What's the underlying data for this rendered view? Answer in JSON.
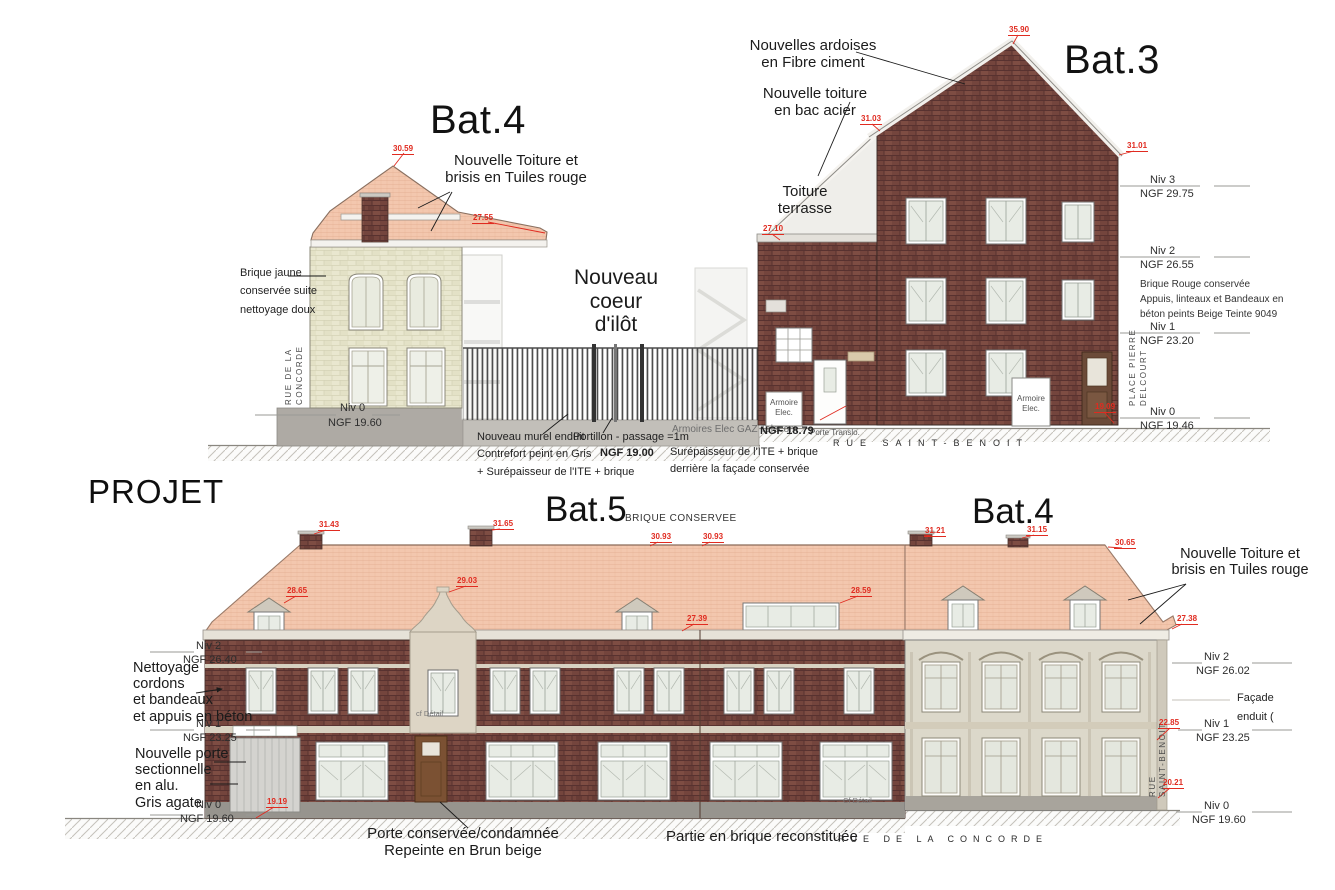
{
  "palette": {
    "brick_red": "#74453d",
    "brick_yellow": "#e9e7cf",
    "roof_tile": "#f3c7ae",
    "facade_cream": "#dcd8ca",
    "marker_red": "#e02b20",
    "ground_gray": "#b3b0aa"
  },
  "top": {
    "bat4": {
      "title": "Bat.4",
      "roof_note": [
        "Nouvelle Toiture et",
        "brisis en Tuiles rouge"
      ],
      "brick_note": [
        "Brique jaune",
        "conservée suite",
        "nettoyage doux"
      ],
      "street_v": [
        "RUE DE LA",
        "CONCORDE"
      ],
      "level0": [
        "Niv 0",
        "NGF 19.60"
      ],
      "m_peak": "30.59",
      "m_eaves": "27.55"
    },
    "coeur": [
      "Nouveau",
      "coeur",
      "d'ilôt"
    ],
    "bat3": {
      "title": "Bat.3",
      "ardoises": [
        "Nouvelles ardoises",
        "en Fibre ciment"
      ],
      "bac_acier": [
        "Nouvelle toiture",
        "en bac acier"
      ],
      "terrasse": [
        "Toiture",
        "terrasse"
      ],
      "brique_note": [
        "Brique Rouge conservée",
        "Appuis, linteaux et Bandeaux en",
        "béton peints  Beige Teinte 9049"
      ],
      "place_v": [
        "PLACE PIERRE",
        "DELCOURT"
      ],
      "armoire": [
        "Armoire",
        "Elec."
      ],
      "porte_translo": "Porte Translo.",
      "street": "RUE SAINT-BENOIT",
      "levels": [
        [
          "Niv 3",
          "NGF 29.75"
        ],
        [
          "Niv 2",
          "NGF 26.55"
        ],
        [
          "Niv 1",
          "NGF 23.20"
        ],
        [
          "Niv 0",
          "NGF 19.46"
        ]
      ],
      "m_peak": "35.90",
      "m_shoulder": "31.03",
      "m_eaves": "31.01",
      "m_wing": "27.10",
      "m_base": "19.09"
    },
    "ground": {
      "murel": [
        "Nouveau murel enduit",
        "Contrefort peint en Gris",
        "+ Surépaisseur de l'ITE + brique"
      ],
      "portillon": [
        "Portillon - passage =1m",
        "NGF 19.00"
      ],
      "armoires": "Armoires Elec GAZ Telecom",
      "armoires_ngf": "NGF 18.79",
      "surep": [
        "Surépaisseur de l'ITE + brique",
        "derrière la façade conservée"
      ]
    }
  },
  "bottom": {
    "projet": "PROJET",
    "bat5_title": "Bat.5",
    "bat5_subtitle": "BRIQUE CONSERVEE",
    "bat4_title": "Bat.4",
    "roof_note": [
      "Nouvelle Toiture et",
      "brisis en Tuiles rouge"
    ],
    "nettoyage": [
      "Nettoyage",
      "cordons",
      "et bandeaux",
      "et appuis en béton"
    ],
    "porte": [
      "Nouvelle porte",
      "sectionnelle",
      "en alu.",
      "Gris agate"
    ],
    "levels_left": [
      [
        "Niv 2",
        "NGF 26.40"
      ],
      [
        "Niv 1",
        "NGF 23.25"
      ],
      [
        "Niv 0",
        "NGF 19.60"
      ]
    ],
    "levels_right": [
      [
        "Niv 2",
        "NGF 26.02"
      ],
      [
        "Niv 1",
        "NGF 23.25"
      ],
      [
        "Niv 0",
        "NGF 19.60"
      ]
    ],
    "facade_note": [
      "Façade",
      "enduit ("
    ],
    "rue_sb_v": [
      "RUE",
      "SAINT-BENOIT"
    ],
    "captions": {
      "porte": [
        "Porte conservée/condamnée",
        "Repeinte en Brun beige"
      ],
      "brique": "Partie en brique reconstituée"
    },
    "street": "RUE DE LA CONCORDE",
    "details": [
      "cf Détail",
      "Cf Détail"
    ],
    "m": {
      "chim1": "31.43",
      "chim2": "31.65",
      "ridge1": "30.93",
      "ridge2": "30.93",
      "rchim1": "31.21",
      "rchim2": "31.15",
      "rridge": "30.65",
      "dorml": "28.65",
      "gable": "29.03",
      "dormr": "28.59",
      "eaves_m": "27.39",
      "eaves_r": "27.38",
      "niv1r": "22.85",
      "base_r": "20.21",
      "base_l": "19.19"
    }
  }
}
